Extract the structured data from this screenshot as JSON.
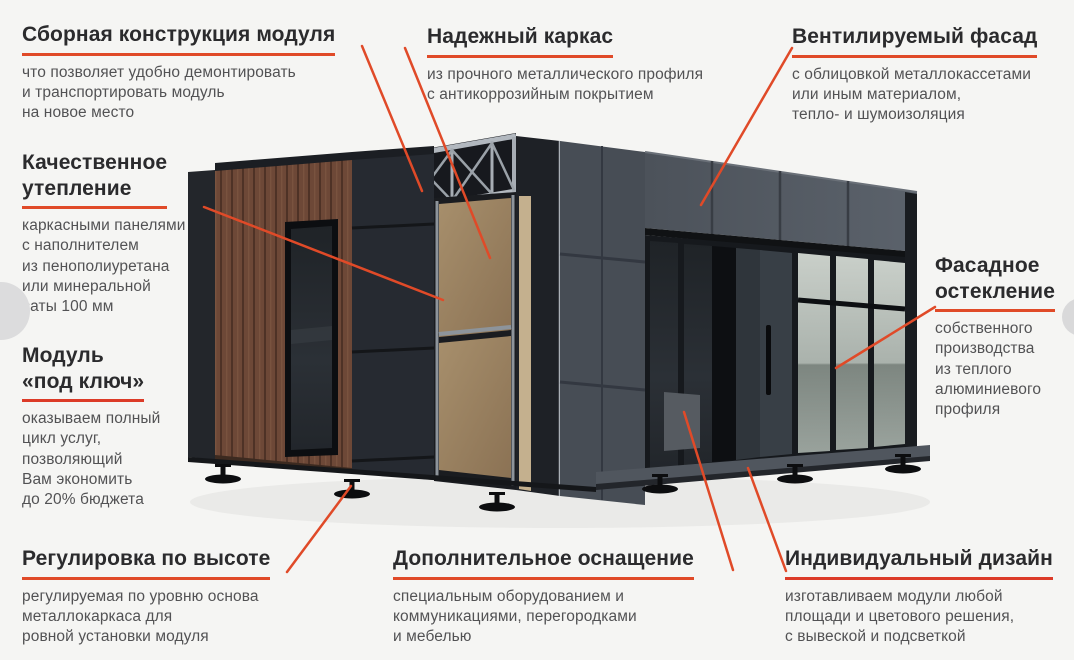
{
  "colors": {
    "background": "#f5f5f3",
    "heading": "#2b2b2d",
    "body_text": "#525254",
    "accent_orange": "#e04a28",
    "accent_red": "#dc3b28"
  },
  "labels": {
    "assembly": {
      "heading": "Сборная конструкция модуля",
      "body": "что позволяет удобно демонтировать\nи транспортировать модуль\nна новое место"
    },
    "frame": {
      "heading": "Надежный каркас",
      "body": "из прочного металлического профиля\nс антикоррозийным покрытием"
    },
    "vent_facade": {
      "heading": "Вентилируемый фасад",
      "body": "с облицовкой металлокассетами\nили иным материалом,\nтепло- и шумоизоляция"
    },
    "insulation": {
      "heading": "Качественное\nутепление",
      "body": "каркасными панелями\nс наполнителем\nиз пенополиуретана\nили минеральной\nваты 100 мм"
    },
    "turnkey": {
      "heading": "Модуль\n«под ключ»",
      "body": "оказываем полный\nцикл услуг,\nпозволяющий\nВам экономить\nдо 20% бюджета"
    },
    "glazing": {
      "heading": "Фасадное\nостекление",
      "body": "собственного\nпроизводства\nиз теплого\nалюминиевого\nпрофиля"
    },
    "height_adjust": {
      "heading": "Регулировка по высоте",
      "body": "регулируемая по уровню основа\nметаллокаркаса для\nровной установки модуля"
    },
    "equipment": {
      "heading": "Дополнительное оснащение",
      "body": "специальным оборудованием и\nкоммуникациями, перегородками\nи мебелью"
    },
    "design": {
      "heading": "Индивидуальный дизайн",
      "body": "изготавливаем модули любой\nплощади и цветового решения,\nс вывеской и подсветкой"
    }
  },
  "carousel": {
    "prev_icon": "chevron-left-circle",
    "next_icon": "chevron-right-circle"
  }
}
